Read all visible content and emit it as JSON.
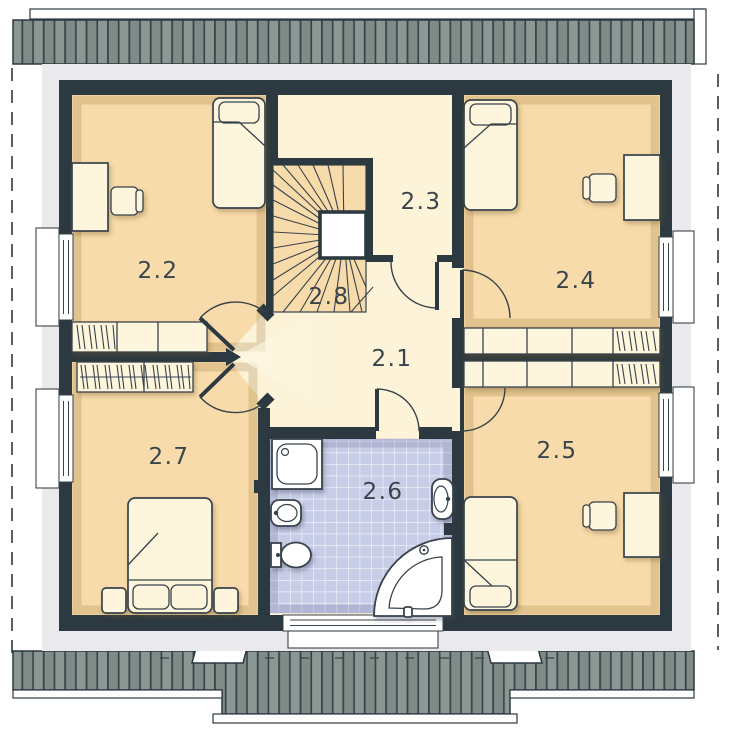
{
  "title": "upper-floor-plan",
  "rooms": [
    {
      "label": "2.1"
    },
    {
      "label": "2.2"
    },
    {
      "label": "2.3"
    },
    {
      "label": "2.4"
    },
    {
      "label": "2.5"
    },
    {
      "label": "2.6"
    },
    {
      "label": "2.7"
    },
    {
      "label": "2.8"
    }
  ],
  "colors": {
    "pageBg": "#ffffff",
    "wall": "#2c3940",
    "outline": "#39434b",
    "bedroomFloor": "#f8dbaa",
    "hallFloor": "#fcf3d8",
    "bathFloor": "#c8cde7",
    "furniture": "#fdf6dd",
    "fixtureWhite": "#ffffff",
    "roofBase": "#7e8b86",
    "roofPanel": "#8a9792",
    "roofLine": "#39444a",
    "eaves": "#eaeaed",
    "labelColor": "#3a444b"
  }
}
